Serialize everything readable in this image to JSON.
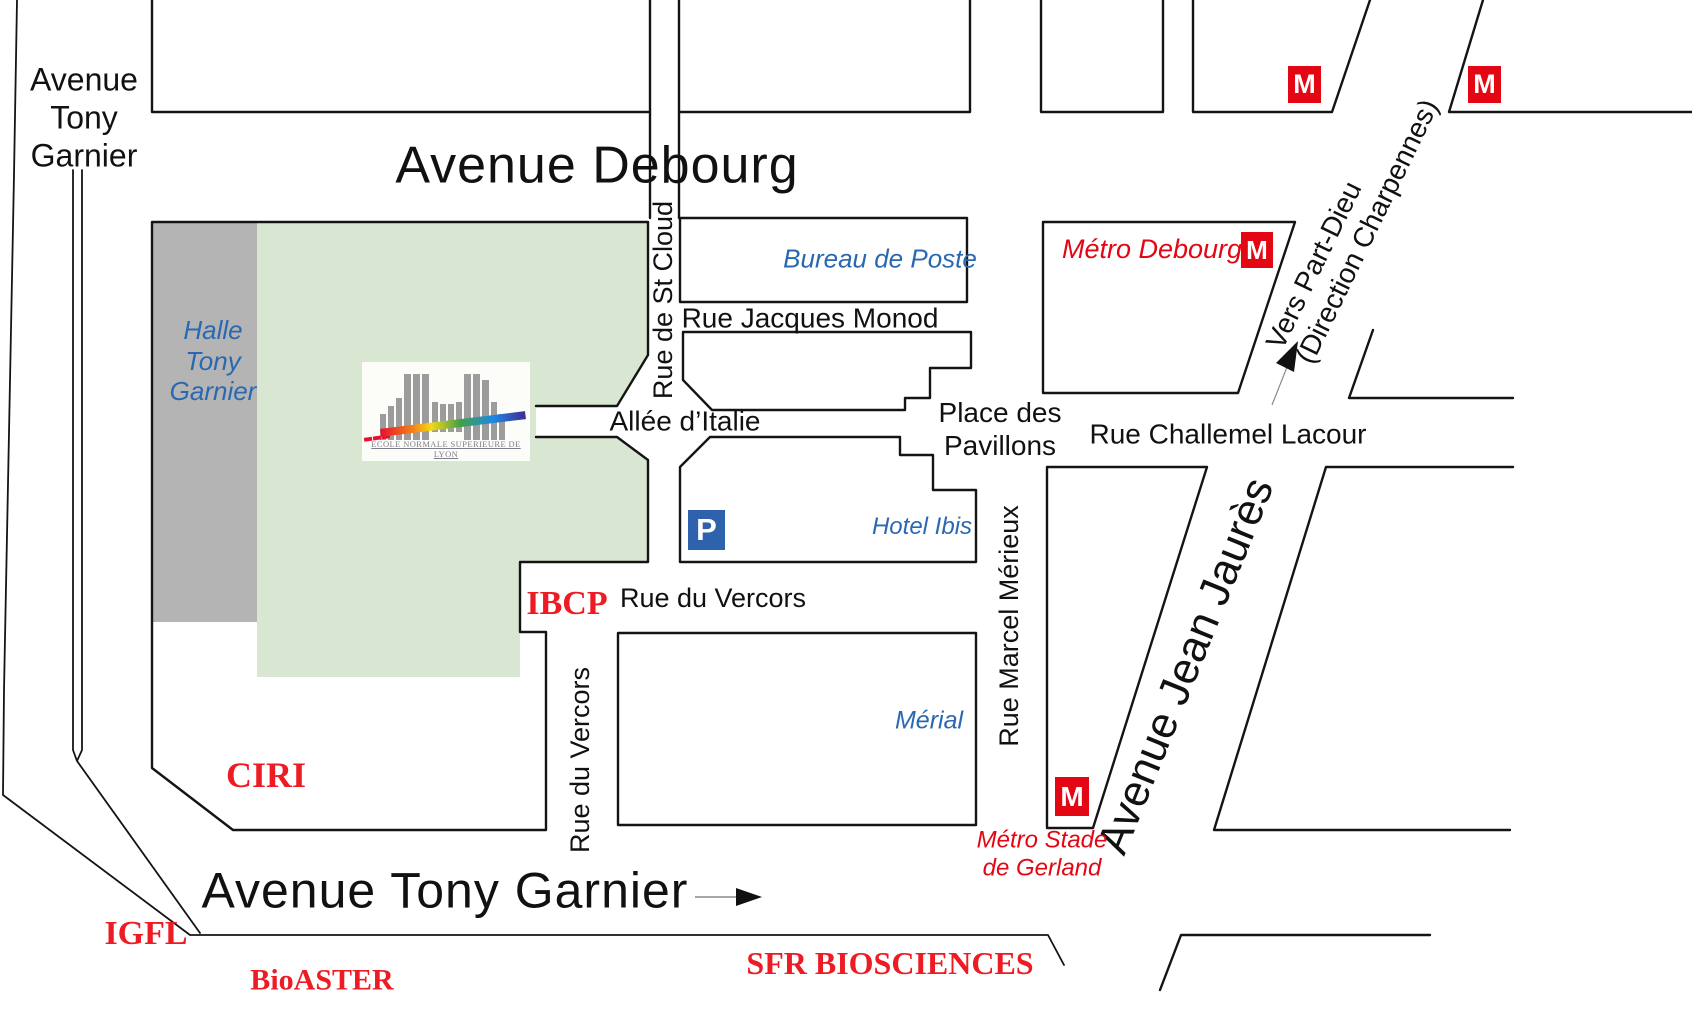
{
  "colors": {
    "campus_green": "#d9e6d2",
    "halle_gray": "#b4b4b4",
    "outline_black": "#141414",
    "blue_label": "#2a68b2",
    "red_serif_label": "#ed1c24",
    "metro_red": "#e30613",
    "parking_blue": "#2e62ac"
  },
  "labels": {
    "avenue_tony_garnier_top": {
      "l1": "Avenue",
      "l2": "Tony",
      "l3": "Garnier"
    },
    "avenue_debourg": "Avenue Debourg",
    "rue_de_st_cloud": "Rue de St Cloud",
    "bureau_de_poste": "Bureau de Poste",
    "rue_jacques_monod": "Rue Jacques Monod",
    "metro_debourg": "Métro Debourg",
    "vers_part_dieu": {
      "l1": "Vers Part-Dieu",
      "l2": "(Direction Charpennes)"
    },
    "halle_tony_garnier": {
      "l1": "Halle",
      "l2": "Tony",
      "l3": "Garnier"
    },
    "allee_d_italie": "Allée d’Italie",
    "place_des_pavillons": {
      "l1": "Place des",
      "l2": "Pavillons"
    },
    "rue_challemel_lacour": "Rue Challemel Lacour",
    "hotel_ibis": "Hotel Ibis",
    "parking_p": "P",
    "metro_m": "M",
    "ibcp": "IBCP",
    "rue_du_vercors_horizontal": "Rue du Vercors",
    "rue_du_vercors_vertical": "Rue du Vercors",
    "merial": "Mérial",
    "rue_marcel_merieux": "Rue Marcel Mérieux",
    "avenue_jean_jaures": "Avenue Jean Jaurès",
    "metro_stade_de_gerland": {
      "l1": "Métro Stade",
      "l2": "de Gerland"
    },
    "ciri": "CIRI",
    "avenue_tony_garnier_bottom": "Avenue Tony Garnier",
    "igfl": "IGFL",
    "bioaster": "BioASTER",
    "sfr_biosciences": "SFR BIOSCIENCES",
    "ens_logo_caption": "ECOLE NORMALE SUPERIEURE DE LYON"
  }
}
